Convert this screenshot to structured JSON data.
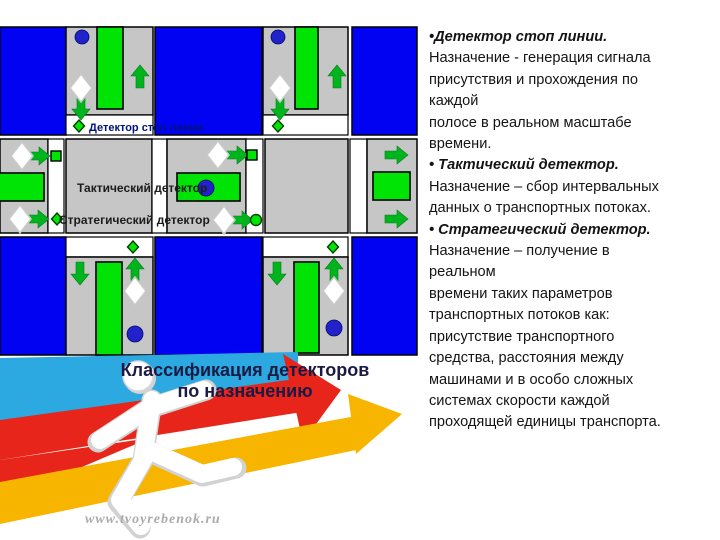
{
  "colors": {
    "block_blue": "#0202F2",
    "road_gray": "#C6C6C6",
    "zone_green": "#00E405",
    "arrow_green": "#00B41E",
    "dot_blue": "#2222CC",
    "label_navy": "#00127B",
    "text_black": "#141414",
    "title_navy": "#1A1A44",
    "band_cyan": "#2BA9E0",
    "band_red": "#E8251A",
    "band_yellow": "#F7B500",
    "watermark_gray": "#ABABAB"
  },
  "diagram": {
    "labels": {
      "stop_line": "Детектор стоп линии",
      "tactical": "Тактический детектор",
      "strategic": "Стратегический детектор"
    }
  },
  "title": {
    "line1": "Классификация детекторов",
    "line2": "по назначению"
  },
  "watermark": "www.tvoyrebenok.ru",
  "info": {
    "lines": [
      {
        "t": "•Детектор стоп линии.",
        "lead": true
      },
      {
        "t": "Назначение - генерация сигнала",
        "lead": false
      },
      {
        "t": "присутствия и прохождения по",
        "lead": false
      },
      {
        "t": "каждой",
        "lead": false
      },
      {
        "t": "полосе в реальном масштабе",
        "lead": false
      },
      {
        "t": "времени.",
        "lead": false
      },
      {
        "t": "• Тактический детектор.",
        "lead": true
      },
      {
        "t": "Назначение – сбор интервальных",
        "lead": false
      },
      {
        "t": "данных о транспортных потоках.",
        "lead": false
      },
      {
        "t": "• Стратегический детектор.",
        "lead": true
      },
      {
        "t": "Назначение – получение в",
        "lead": false
      },
      {
        "t": "реальном",
        "lead": false
      },
      {
        "t": "времени таких параметров",
        "lead": false
      },
      {
        "t": "транспортных потоков как:",
        "lead": false
      },
      {
        "t": "присутствие транспортного",
        "lead": false
      },
      {
        "t": "средства, расстояния между",
        "lead": false
      },
      {
        "t": "машинами и в особо сложных",
        "lead": false
      },
      {
        "t": "системах скорости каждой",
        "lead": false
      },
      {
        "t": "проходящей единицы транспорта.",
        "lead": false
      }
    ]
  }
}
